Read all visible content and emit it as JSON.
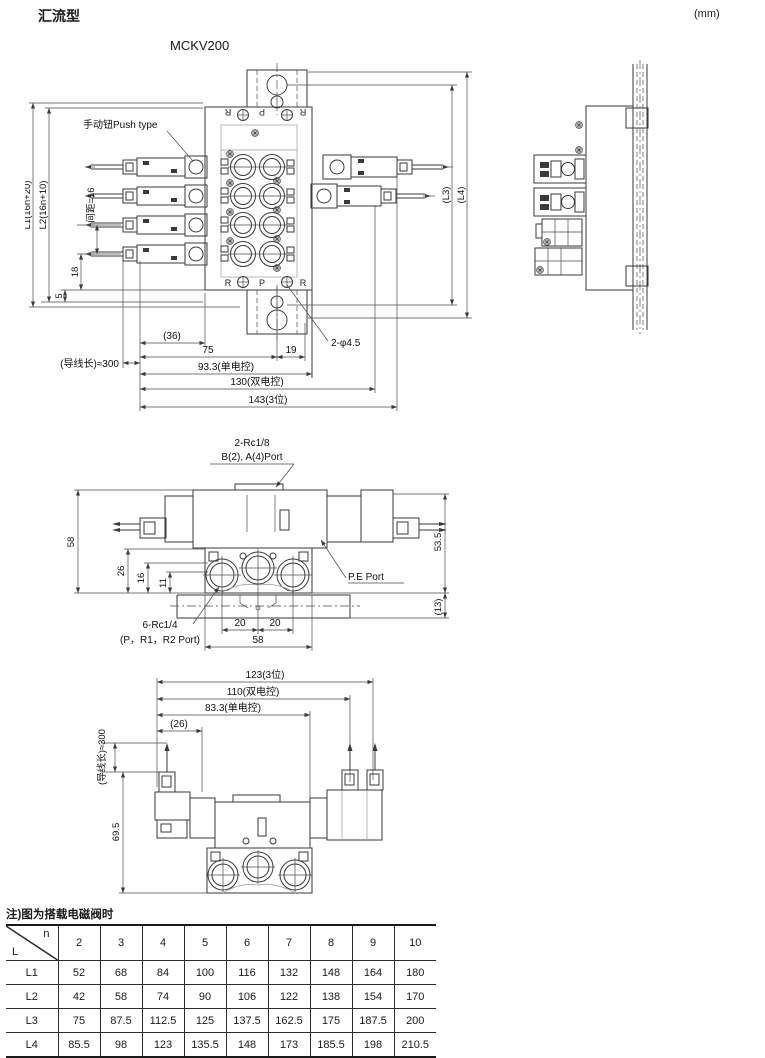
{
  "page": {
    "title": "汇流型",
    "unit": "(mm)",
    "model": "MCKV200",
    "note": "注)图为搭载电磁阀时"
  },
  "top_view": {
    "push_label": "手动钮Push type",
    "ports_top": {
      "r1": "R",
      "p": "P",
      "r2": "R"
    },
    "ports_bottom": {
      "r1": "R",
      "p": "P",
      "r2": "R"
    },
    "dims": {
      "l1": "L1(16n+20)",
      "l2": "L2(16n+10)",
      "pitch": "间距=16",
      "d18": "18",
      "d5": "5",
      "lead": "(导线长)≈300",
      "d36": "(36)",
      "d75": "75",
      "d19": "19",
      "d93": "93.3(单电控)",
      "d130": "130(双电控)",
      "d143": "143(3位)",
      "hole": "2-φ4.5",
      "l3": "(L3)",
      "l4": "(L4)"
    }
  },
  "front_view": {
    "labels": {
      "rc18_1": "2-Rc1/8",
      "rc18_2": "B(2), A(4)Port",
      "pe": "P.E Port",
      "rc14_1": "6-Rc1/4",
      "rc14_2": "(P，R1，R2 Port)"
    },
    "dims": {
      "d58l": "58",
      "d26": "26",
      "d16": "16",
      "d11": "11",
      "d535": "53.5",
      "d13": "(13)",
      "d20a": "20",
      "d20b": "20",
      "d58b": "58"
    }
  },
  "bottom_view": {
    "dims": {
      "d123": "123(3位)",
      "d110": "110(双电控)",
      "d83": "83.3(单电控)",
      "d26": "(26)",
      "lead": "(导线长)≈300",
      "d69": "69.5"
    }
  },
  "table": {
    "corner": {
      "top": "n",
      "bottom": "L"
    },
    "columns": [
      "2",
      "3",
      "4",
      "5",
      "6",
      "7",
      "8",
      "9",
      "10"
    ],
    "rows": [
      {
        "label": "L1",
        "values": [
          "52",
          "68",
          "84",
          "100",
          "116",
          "132",
          "148",
          "164",
          "180"
        ]
      },
      {
        "label": "L2",
        "values": [
          "42",
          "58",
          "74",
          "90",
          "106",
          "122",
          "138",
          "154",
          "170"
        ]
      },
      {
        "label": "L3",
        "values": [
          "75",
          "87.5",
          "112.5",
          "125",
          "137.5",
          "162.5",
          "175",
          "187.5",
          "200"
        ]
      },
      {
        "label": "L4",
        "values": [
          "85.5",
          "98",
          "123",
          "135.5",
          "148",
          "173",
          "185.5",
          "198",
          "210.5"
        ]
      }
    ]
  }
}
